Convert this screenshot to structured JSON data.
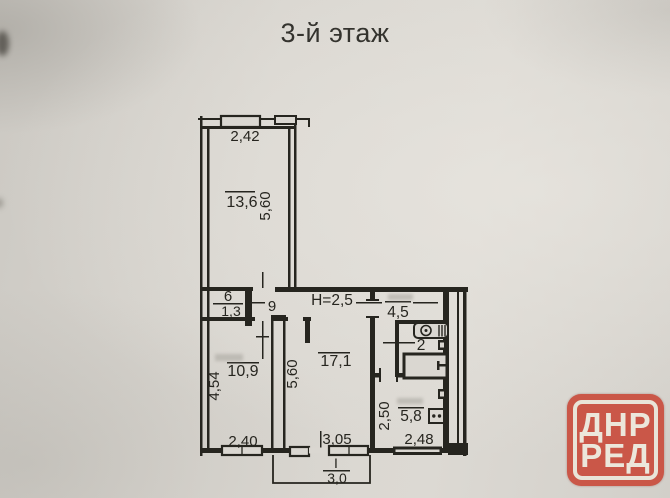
{
  "title": "3-й этаж",
  "plan": {
    "ceiling_height": "Н=2,5",
    "room_top": {
      "area": "13,6",
      "width": "2,42",
      "depth": "5,60"
    },
    "room_left": {
      "area": "10,9",
      "depth": "4,54",
      "width": "2,40"
    },
    "room_main": {
      "area": "17,1",
      "depth": "5,60",
      "width": "3,05"
    },
    "closet": {
      "number": "6",
      "area": "1,3"
    },
    "corridor_label": "9",
    "hallway": {
      "area": "4,5"
    },
    "bathroom": {
      "area": "2"
    },
    "kitchen": {
      "area": "5,8",
      "depth": "2,50",
      "width": "2,48"
    },
    "balcony": {
      "number": "I",
      "width": "3,0"
    }
  },
  "watermark": {
    "line1": "ДНР",
    "line2": "РЕД"
  },
  "colors": {
    "stamp_red": "#ca5748",
    "ink": "#26251f",
    "paper": "#d8d5cf"
  }
}
